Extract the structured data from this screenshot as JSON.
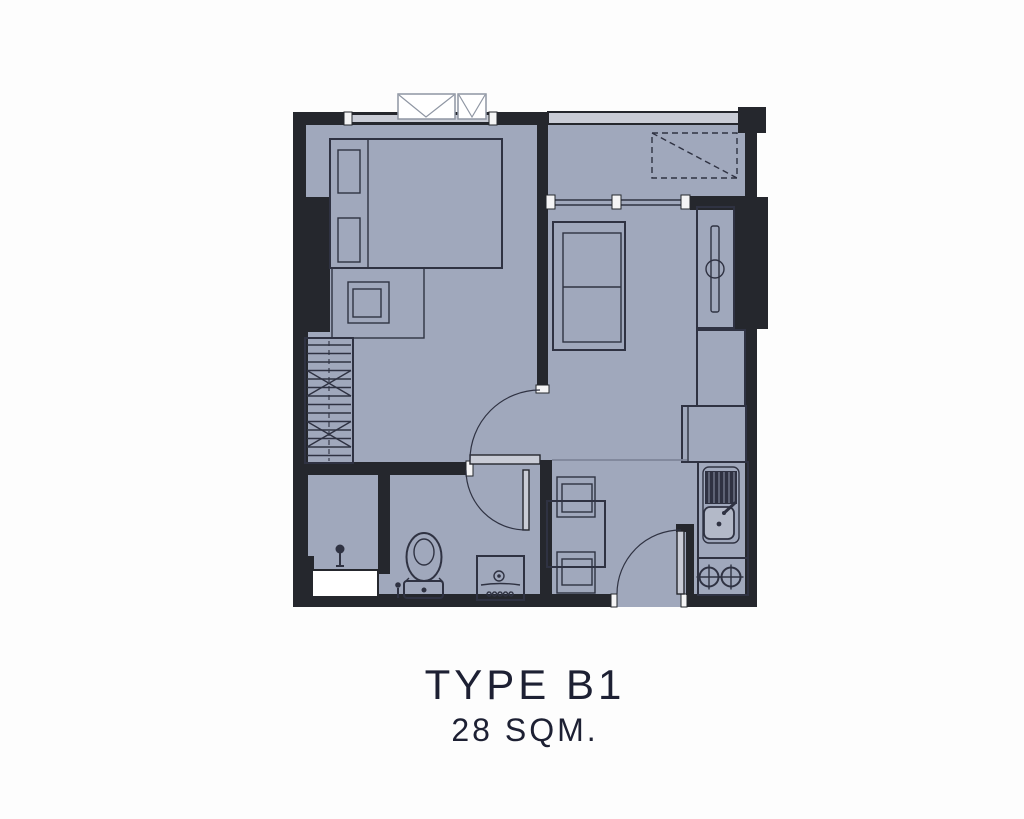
{
  "plan": {
    "type_label": "TYPE B1",
    "area_label": "28 SQM."
  },
  "palette": {
    "bg": "#fdfdfd",
    "floor": "#a0a8bc",
    "wall": "#25272d",
    "stroke": "#2f3242",
    "window-band": "#c9ccd6",
    "post": "#f4f4f5",
    "white": "#ffffff",
    "box-border": "#8f96a3",
    "hall-line": "#7e8599",
    "text": "#1d2033",
    "bowl": "#b3b9c8",
    "stripe": "#8b92a6"
  }
}
